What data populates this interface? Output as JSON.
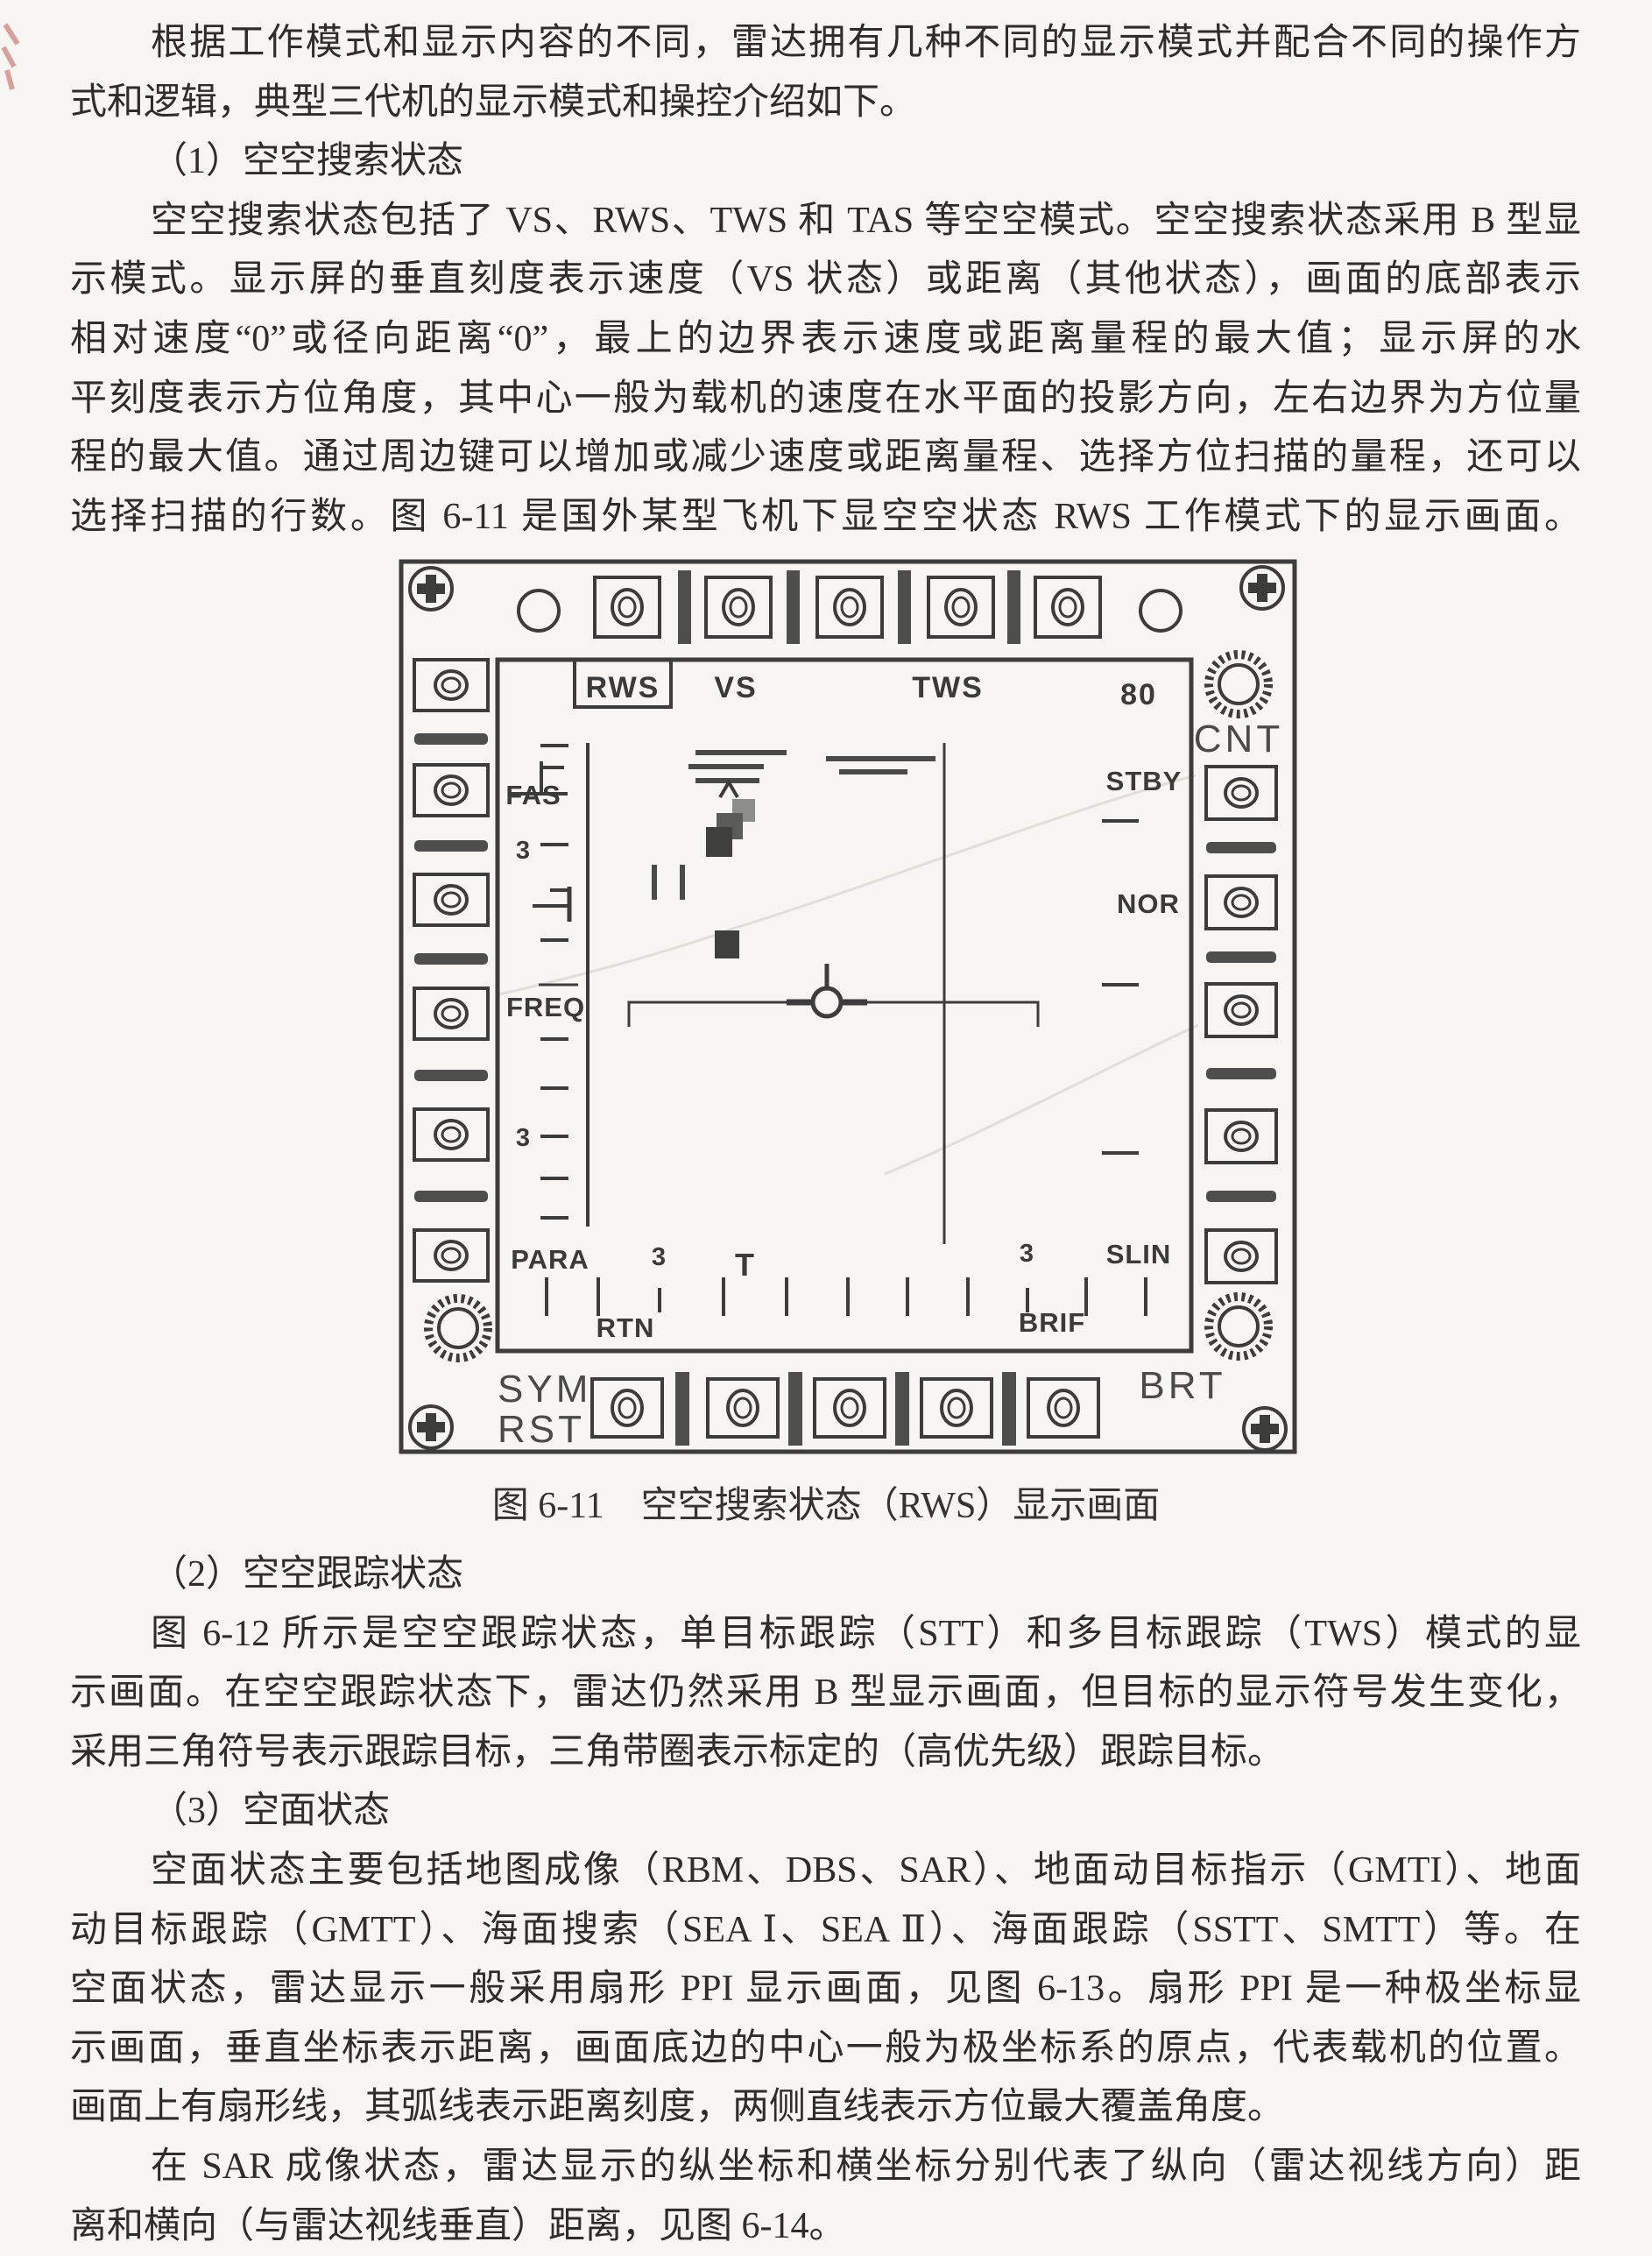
{
  "doc": {
    "top": [
      "根据工作模式和显示内容的不同，雷达拥有几种不同的显示模式并配合不同的操作方",
      "式和逻辑，典型三代机的显示模式和操控介绍如下。",
      "（1）空空搜索状态",
      "空空搜索状态包括了 VS、RWS、TWS 和 TAS 等空空模式。空空搜索状态采用 B 型显",
      "示模式。显示屏的垂直刻度表示速度（VS 状态）或距离（其他状态），画面的底部表示",
      "相对速度“0”或径向距离“0”，最上的边界表示速度或距离量程的最大值；显示屏的水",
      "平刻度表示方位角度，其中心一般为载机的速度在水平面的投影方向，左右边界为方位量",
      "程的最大值。通过周边键可以增加或减少速度或距离量程、选择方位扫描的量程，还可以",
      "选择扫描的行数。图 6-11 是国外某型飞机下显空空状态 RWS 工作模式下的显示画面。"
    ],
    "bottom": [
      "（2）空空跟踪状态",
      "图 6-12 所示是空空跟踪状态，单目标跟踪（STT）和多目标跟踪（TWS）模式的显",
      "示画面。在空空跟踪状态下，雷达仍然采用 B 型显示画面，但目标的显示符号发生变化，",
      "采用三角符号表示跟踪目标，三角带圈表示标定的（高优先级）跟踪目标。",
      "（3）空面状态",
      "空面状态主要包括地图成像（RBM、DBS、SAR）、地面动目标指示（GMTI）、地面",
      "动目标跟踪（GMTT）、海面搜索（SEA Ⅰ、SEA Ⅱ）、海面跟踪（SSTT、SMTT）等。在",
      "空面状态，雷达显示一般采用扇形 PPI 显示画面，见图 6-13。扇形 PPI 是一种极坐标显",
      "示画面，垂直坐标表示距离，画面底边的中心一般为极坐标系的原点，代表载机的位置。",
      "画面上有扇形线，其弧线表示距离刻度，两侧直线表示方位最大覆盖角度。",
      "在 SAR 成像状态，雷达显示的纵坐标和横坐标分别代表了纵向（雷达视线方向）距",
      "离和横向（与雷达视线垂直）距离，见图 6-14。"
    ]
  },
  "figure": {
    "caption": "图 6-11　空空搜索状态（RWS）显示画面",
    "modes": {
      "active": "RWS",
      "vs": "VS",
      "tws": "TWS",
      "range": "80"
    },
    "left": {
      "fas": "FAS",
      "three_a": "3",
      "freq": "FREQ",
      "three_b": "3",
      "para": "PARA"
    },
    "right": {
      "stby": "STBY",
      "nor": "NOR",
      "slin": "SLIN",
      "brif": "BRIF"
    },
    "bottom": {
      "rtn": "RTN",
      "three_left": "3",
      "t": "T",
      "three_right": "3",
      "brif_x": ""
    },
    "knobs": {
      "cnt": "CNT",
      "brt": "BRT"
    },
    "side": {
      "sym": "SYM",
      "rst": "RST"
    }
  }
}
